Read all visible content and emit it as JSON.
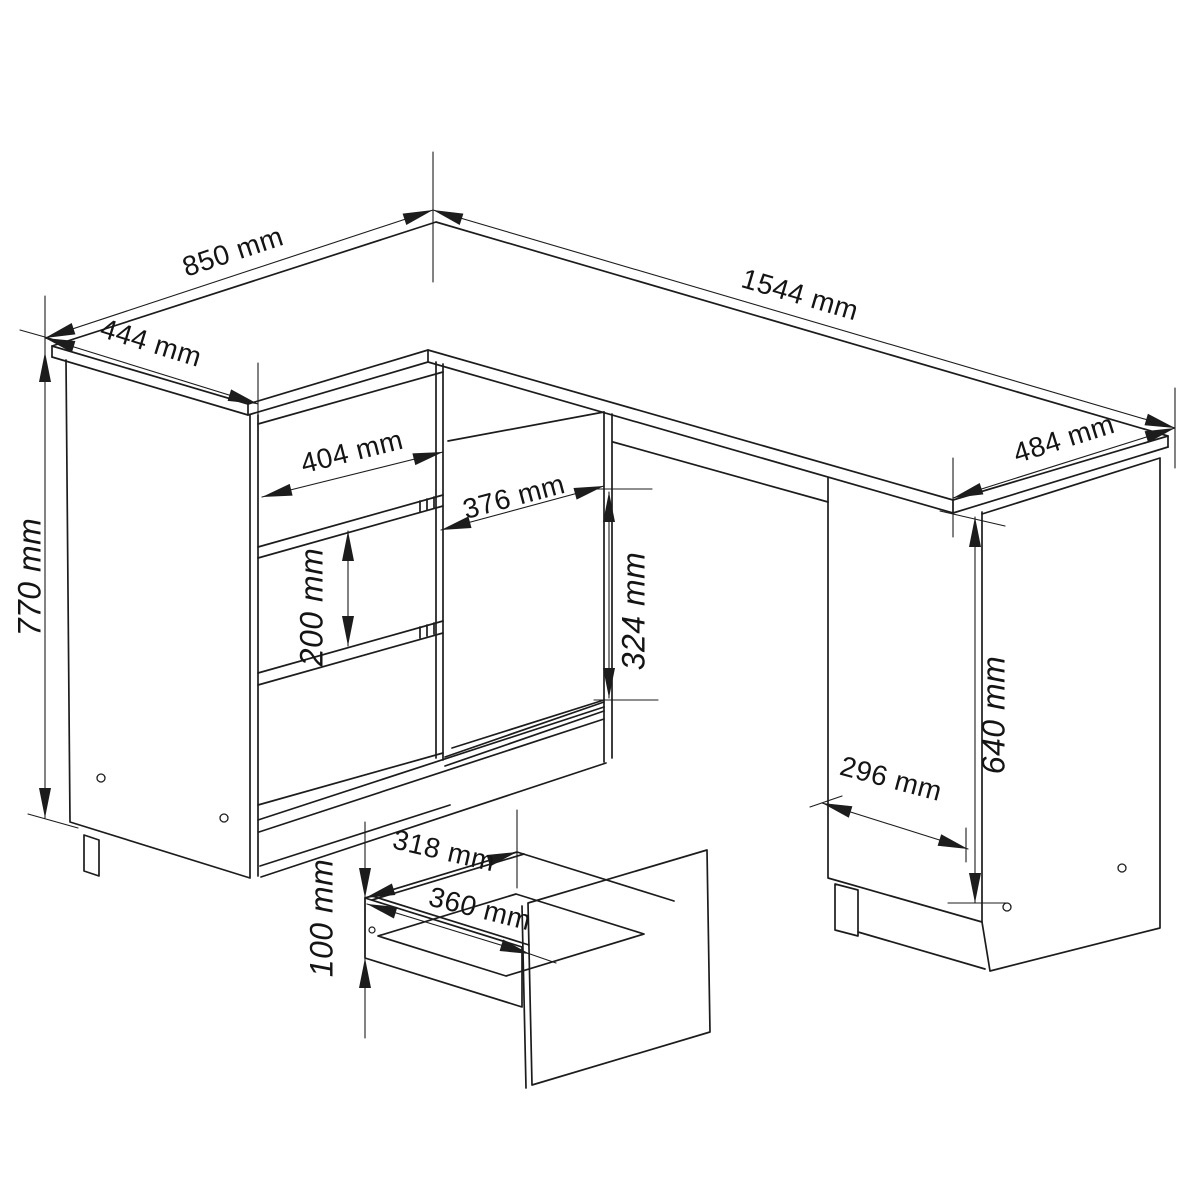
{
  "drawing": {
    "type": "furniture-technical-dimension-drawing",
    "subject": "L-shaped corner desk with three drawers, open shelf compartment, side cabinet and pull-out drawer detail",
    "unit": "mm",
    "line_color": "#1c1c1c",
    "background_color": "#ffffff",
    "dimensions": [
      {
        "id": "desk-left-top-depth",
        "text": "850 mm",
        "value": 850,
        "x": 233,
        "y": 252,
        "rot": -18.3
      },
      {
        "id": "desk-left-top-width",
        "text": "444 mm",
        "value": 444,
        "x": 151,
        "y": 343,
        "rot": 17.2
      },
      {
        "id": "desk-main-top-length",
        "text": "1544 mm",
        "value": 1544,
        "x": 800,
        "y": 295,
        "rot": 16.4
      },
      {
        "id": "desk-right-top-depth",
        "text": "484 mm",
        "value": 484,
        "x": 1064,
        "y": 439,
        "rot": -17.5
      },
      {
        "id": "desk-total-height",
        "text": "770 mm",
        "value": 770,
        "x": 30,
        "y": 577,
        "rot": -90
      },
      {
        "id": "drawer-front-width",
        "text": "404 mm",
        "value": 404,
        "x": 352,
        "y": 452,
        "rot": -14
      },
      {
        "id": "shelf-opening-width",
        "text": "376 mm",
        "value": 376,
        "x": 514,
        "y": 497,
        "rot": -15
      },
      {
        "id": "shelf-opening-height",
        "text": "324 mm",
        "value": 324,
        "x": 634,
        "y": 611,
        "rot": -90
      },
      {
        "id": "drawer-front-height",
        "text": "200 mm",
        "value": 200,
        "x": 312,
        "y": 607,
        "rot": -90
      },
      {
        "id": "side-cabinet-height",
        "text": "640 mm",
        "value": 640,
        "x": 994,
        "y": 715,
        "rot": -90
      },
      {
        "id": "side-cabinet-width",
        "text": "296 mm",
        "value": 296,
        "x": 891,
        "y": 779,
        "rot": 15
      },
      {
        "id": "drawer-box-inner-width",
        "text": "318 mm",
        "value": 318,
        "x": 444,
        "y": 851,
        "rot": 13
      },
      {
        "id": "drawer-box-outer-width",
        "text": "360 mm",
        "value": 360,
        "x": 480,
        "y": 909,
        "rot": 14
      },
      {
        "id": "drawer-box-side-height",
        "text": "100 mm",
        "value": 100,
        "x": 322,
        "y": 918,
        "rot": -90
      }
    ]
  }
}
